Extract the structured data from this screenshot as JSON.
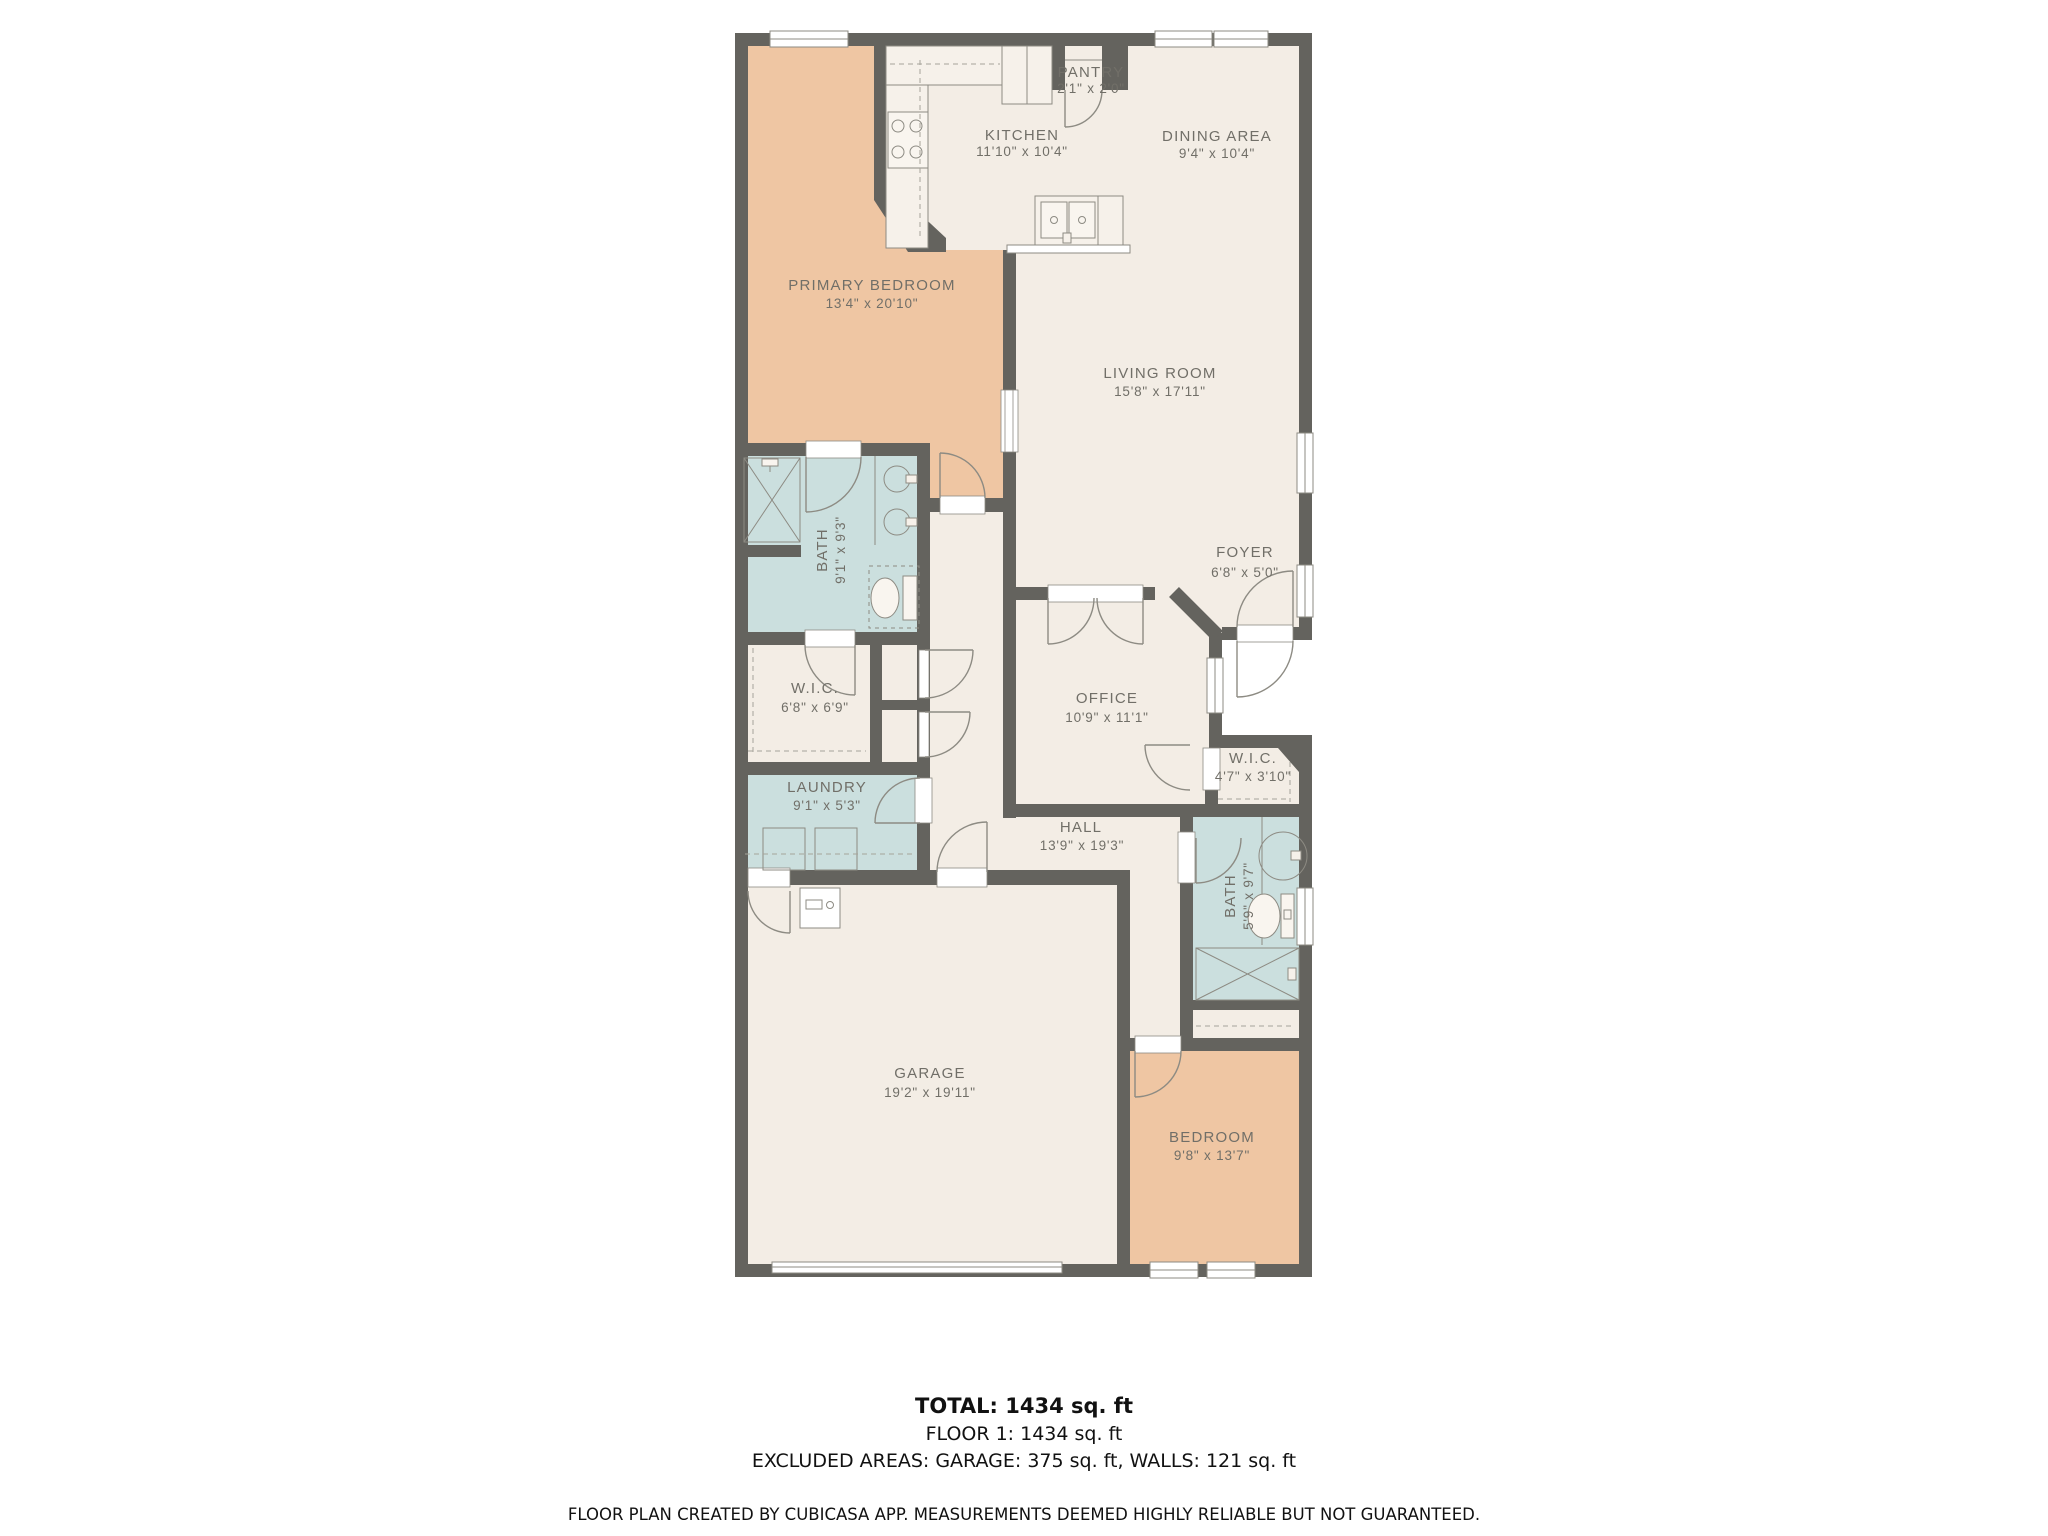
{
  "plan": {
    "colors": {
      "floor": "#F3EDE5",
      "bedroom_fill": "#EFC6A3",
      "wet_room_fill": "#CBDFDE",
      "wall": "#64635E",
      "label_text": "#716F68",
      "fixture_line": "#8D8B83",
      "summary_text": "#111111"
    },
    "rooms": [
      {
        "id": "pantry",
        "name": "PANTRY",
        "dims": "2'1\" x 2'0\""
      },
      {
        "id": "kitchen",
        "name": "KITCHEN",
        "dims": "11'10\" x 10'4\""
      },
      {
        "id": "dining-area",
        "name": "DINING AREA",
        "dims": "9'4\" x 10'4\""
      },
      {
        "id": "primary-bedroom",
        "name": "PRIMARY BEDROOM",
        "dims": "13'4\" x 20'10\""
      },
      {
        "id": "living-room",
        "name": "LIVING ROOM",
        "dims": "15'8\" x 17'11\""
      },
      {
        "id": "foyer",
        "name": "FOYER",
        "dims": "6'8\" x 5'0\""
      },
      {
        "id": "bath-primary",
        "name": "BATH",
        "dims": "9'1\" x 9'3\""
      },
      {
        "id": "wic-primary",
        "name": "W.I.C.",
        "dims": "6'8\" x 6'9\""
      },
      {
        "id": "laundry",
        "name": "LAUNDRY",
        "dims": "9'1\" x 5'3\""
      },
      {
        "id": "office",
        "name": "OFFICE",
        "dims": "10'9\" x 11'1\""
      },
      {
        "id": "wic-2",
        "name": "W.I.C.",
        "dims": "4'7\" x 3'10\""
      },
      {
        "id": "hall",
        "name": "HALL",
        "dims": "13'9\" x 19'3\""
      },
      {
        "id": "bath-2",
        "name": "BATH",
        "dims": "5'9\" x 9'7\""
      },
      {
        "id": "garage",
        "name": "GARAGE",
        "dims": "19'2\" x 19'11\""
      },
      {
        "id": "bedroom-2",
        "name": "BEDROOM",
        "dims": "9'8\" x 13'7\""
      }
    ]
  },
  "summary": {
    "total": "TOTAL: 1434 sq. ft",
    "floor": "FLOOR 1: 1434 sq. ft",
    "excluded": "EXCLUDED AREAS: GARAGE: 375 sq. ft, WALLS: 121 sq. ft"
  },
  "footer": {
    "disclaimer": "FLOOR PLAN CREATED BY CUBICASA APP. MEASUREMENTS DEEMED HIGHLY RELIABLE BUT NOT GUARANTEED."
  }
}
